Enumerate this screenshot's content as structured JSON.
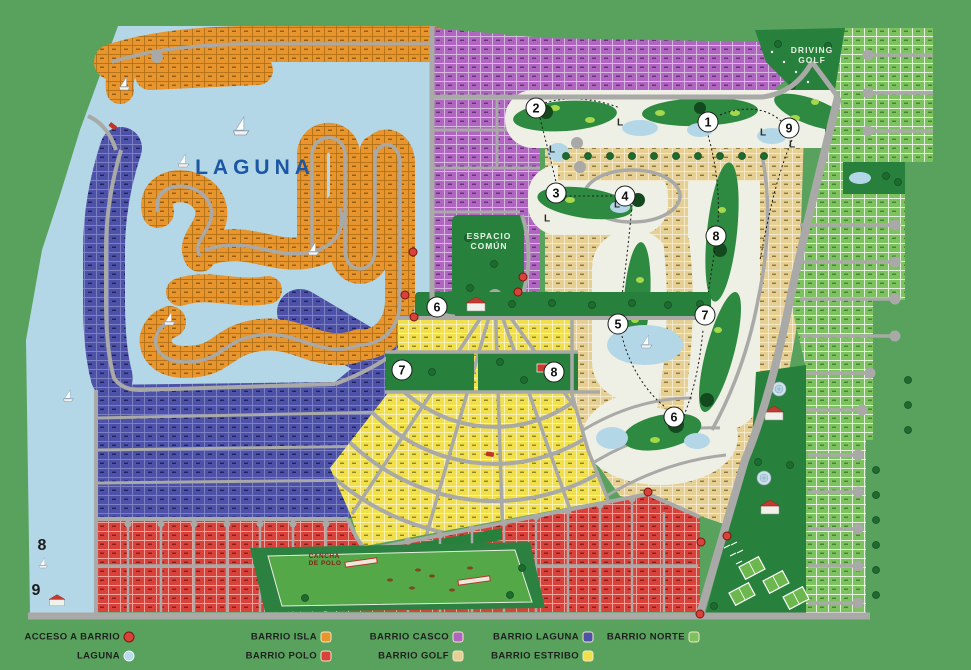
{
  "map": {
    "labels": {
      "laguna": "LAGUNA",
      "espacio_line1": "ESPACIO",
      "espacio_line2": "COMÚN",
      "driving_line1": "DRIVING",
      "driving_line2": "GOLF",
      "cancha_line1": "CANCHA",
      "cancha_line2": "DE POLO"
    },
    "l_label": "L",
    "hole_markers": [
      {
        "n": "2",
        "x": 536,
        "y": 108
      },
      {
        "n": "1",
        "x": 708,
        "y": 122
      },
      {
        "n": "9",
        "x": 789,
        "y": 128
      },
      {
        "n": "3",
        "x": 556,
        "y": 193
      },
      {
        "n": "4",
        "x": 625,
        "y": 196
      },
      {
        "n": "8",
        "x": 716,
        "y": 236
      },
      {
        "n": "6",
        "x": 437,
        "y": 307
      },
      {
        "n": "5",
        "x": 618,
        "y": 324
      },
      {
        "n": "7",
        "x": 705,
        "y": 315
      },
      {
        "n": "7",
        "x": 402,
        "y": 370
      },
      {
        "n": "8",
        "x": 554,
        "y": 372
      },
      {
        "n": "6",
        "x": 674,
        "y": 417
      }
    ],
    "plain_numbers": [
      {
        "n": "8",
        "x": 42,
        "y": 546
      },
      {
        "n": "9",
        "x": 36,
        "y": 591
      }
    ],
    "l_markers": [
      {
        "x": 552,
        "y": 150
      },
      {
        "x": 620,
        "y": 123
      },
      {
        "x": 763,
        "y": 133
      },
      {
        "x": 792,
        "y": 145
      },
      {
        "x": 617,
        "y": 205
      },
      {
        "x": 547,
        "y": 219
      }
    ],
    "access_dots": [
      {
        "x": 413,
        "y": 252
      },
      {
        "x": 523,
        "y": 277
      },
      {
        "x": 518,
        "y": 292
      },
      {
        "x": 405,
        "y": 295
      },
      {
        "x": 414,
        "y": 317
      },
      {
        "x": 648,
        "y": 492
      },
      {
        "x": 701,
        "y": 542
      },
      {
        "x": 727,
        "y": 536
      },
      {
        "x": 700,
        "y": 614
      }
    ]
  },
  "legend": {
    "items": [
      {
        "label": "ACCESO A BARRIO",
        "shape": "circle",
        "color": "#d8423a",
        "border": "#7a150e",
        "x": 129,
        "y": 637
      },
      {
        "label": "LAGUNA",
        "shape": "circle",
        "color": "#b9dcec",
        "border": "#eef6f8",
        "x": 129,
        "y": 656
      },
      {
        "label": "BARRIO ISLA",
        "shape": "square",
        "color": "#e8952e",
        "border": "#f5e6c8",
        "x": 326,
        "y": 637
      },
      {
        "label": "BARRIO POLO",
        "shape": "square",
        "color": "#d8423a",
        "border": "#f5e6c8",
        "x": 326,
        "y": 656
      },
      {
        "label": "BARRIO CASCO",
        "shape": "square",
        "color": "#b065c0",
        "border": "#f5e6c8",
        "x": 458,
        "y": 637
      },
      {
        "label": "BARRIO GOLF",
        "shape": "square",
        "color": "#e5cf92",
        "border": "#f5e6c8",
        "x": 458,
        "y": 656
      },
      {
        "label": "BARRIO LAGUNA",
        "shape": "square",
        "color": "#4d52a8",
        "border": "#f5e6c8",
        "x": 588,
        "y": 637
      },
      {
        "label": "BARRIO ESTRIBO",
        "shape": "square",
        "color": "#f1e04c",
        "border": "#f5e6c8",
        "x": 588,
        "y": 656
      },
      {
        "label": "BARRIO NORTE",
        "shape": "square",
        "color": "#7cc25f",
        "border": "#f5e6c8",
        "x": 694,
        "y": 637
      }
    ]
  },
  "colors": {
    "background": "#58a25d",
    "water": "#b4d7e8",
    "road": "#a9a9a7",
    "park": "#27803b",
    "fairway": "#2e8a40",
    "golf_ground": "#eef0e6"
  }
}
